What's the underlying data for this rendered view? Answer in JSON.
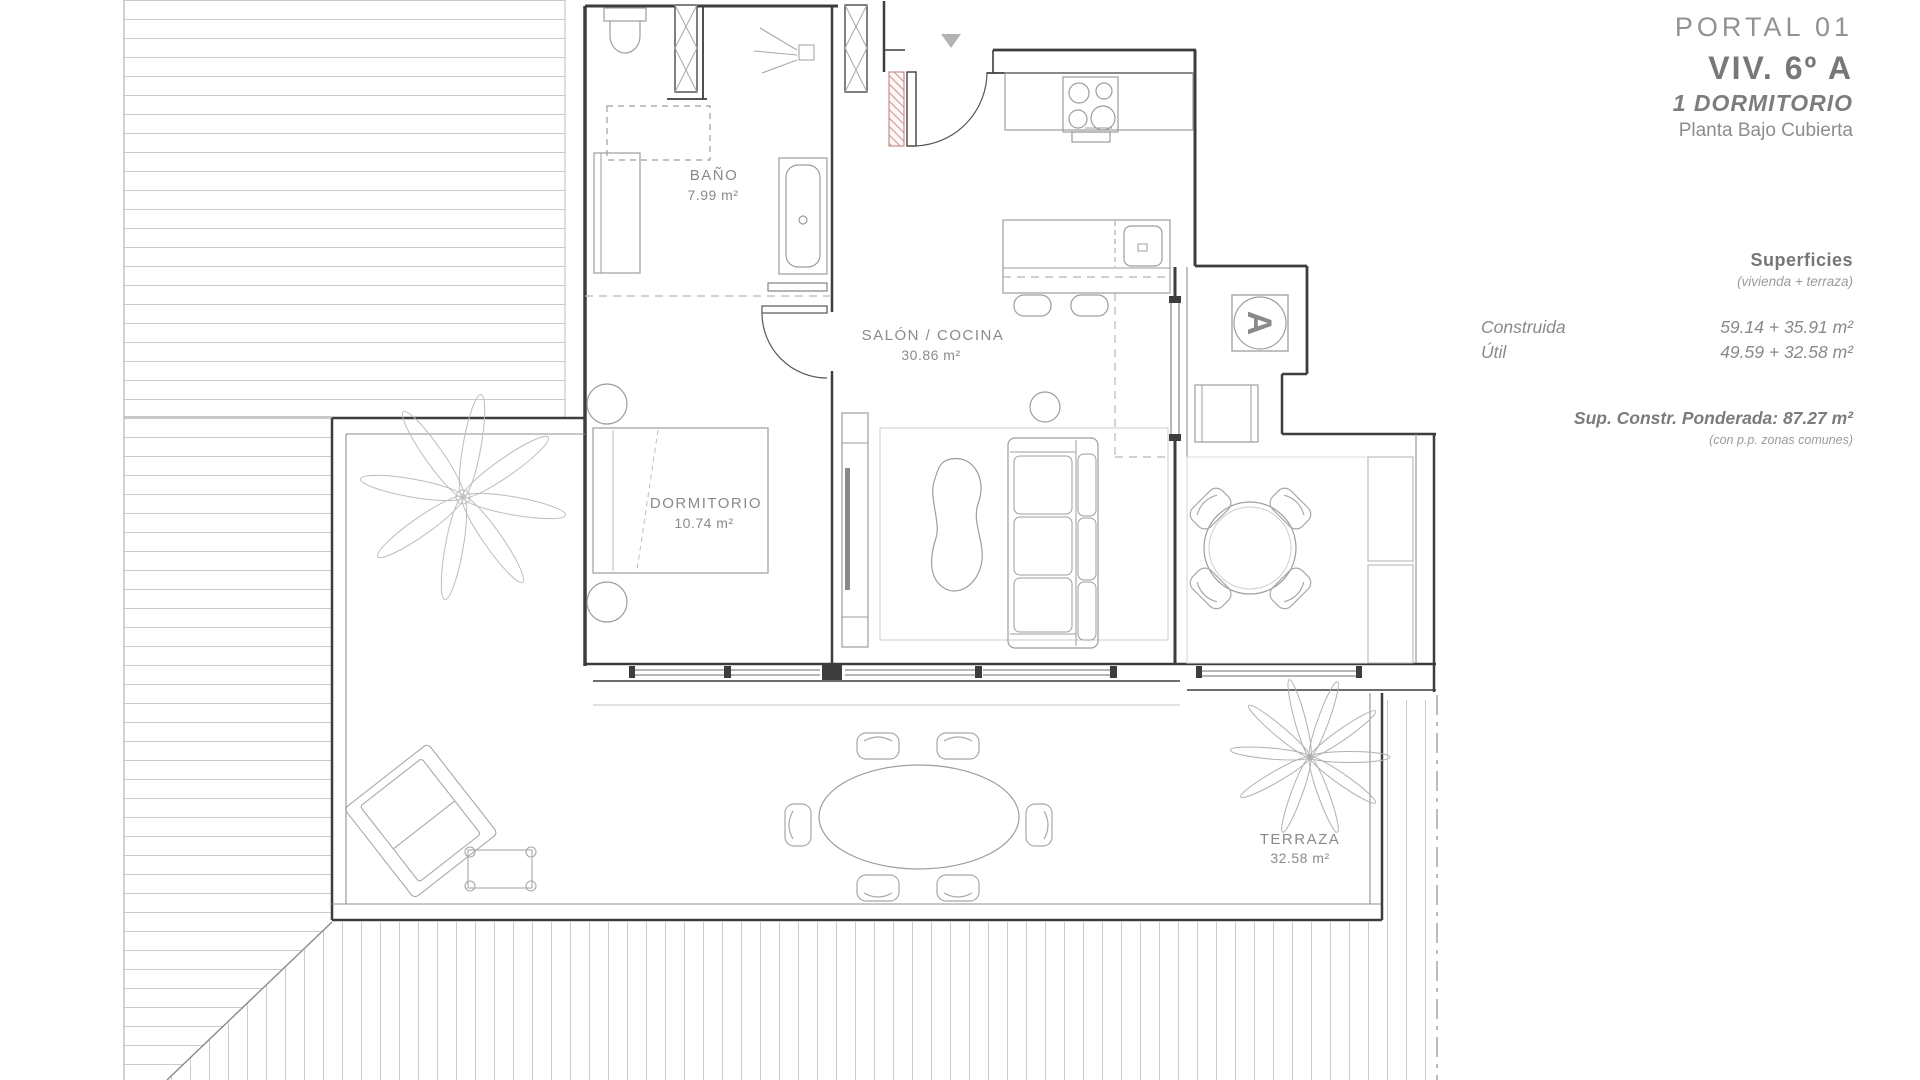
{
  "header": {
    "portal": "PORTAL 01",
    "unit": "VIV. 6º A",
    "type": "1 DORMITORIO",
    "floor": "Planta Bajo Cubierta"
  },
  "surfaces": {
    "title": "Superficies",
    "subtitle": "(vivienda + terraza)",
    "rows": [
      {
        "label": "Construida",
        "value": "59.14 + 35.91 m²"
      },
      {
        "label": "Útil",
        "value": "49.59 + 32.58 m²"
      }
    ],
    "weighted": "Sup. Constr. Ponderada: 87.27 m²",
    "weighted_note": "(con p.p. zonas comunes)"
  },
  "rooms": [
    {
      "name": "BAÑO",
      "area": "7.99 m²"
    },
    {
      "name": "SALÓN / COCINA",
      "area": "30.86 m²"
    },
    {
      "name": "DORMITORIO",
      "area": "10.74 m²"
    },
    {
      "name": "TERRAZA",
      "area": "32.58 m²"
    }
  ],
  "markers": {
    "core_letter": "A"
  },
  "icons": {
    "entrance_marker": "triangle-down"
  },
  "colors": {
    "wall": "#3a3a3a",
    "furniture_line": "#9a9a9a",
    "roof_hatch": "#cbcbcb",
    "text": "#8a8a8a",
    "accent_red": "#cc8b8b"
  }
}
